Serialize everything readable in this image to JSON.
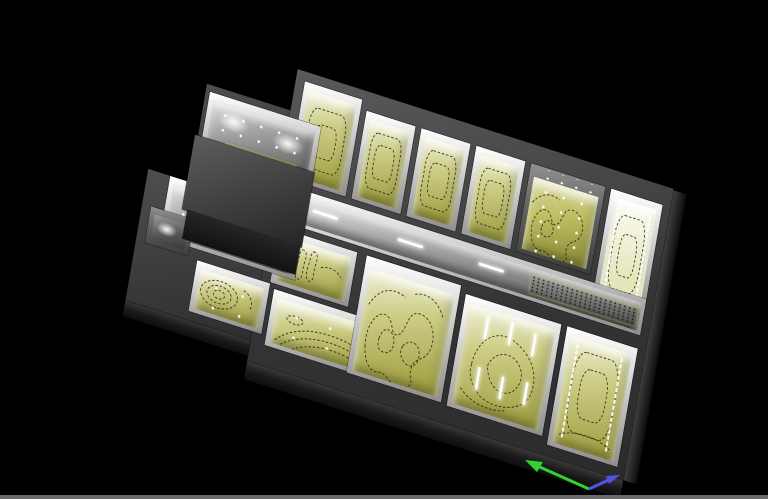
{
  "colors": {
    "background": "#000000",
    "status_bar": "#6a6a6a",
    "wall_top": "#3f3f3f",
    "wall_face": "#1e1e1e",
    "floor_isolux": "#b5b54a",
    "floor_isolux_bright": "#efefd2",
    "floor_neutral": "#8c8c8c",
    "contour_line": "#21210a",
    "luminaire": "#ffffff",
    "furniture_block": "#3a3a3a",
    "axis_green": "#2fd42f",
    "axis_blue": "#5055e6"
  },
  "axis_gizmo": {
    "axes": [
      "green-axis-arrow",
      "blue-axis-arrow"
    ]
  }
}
